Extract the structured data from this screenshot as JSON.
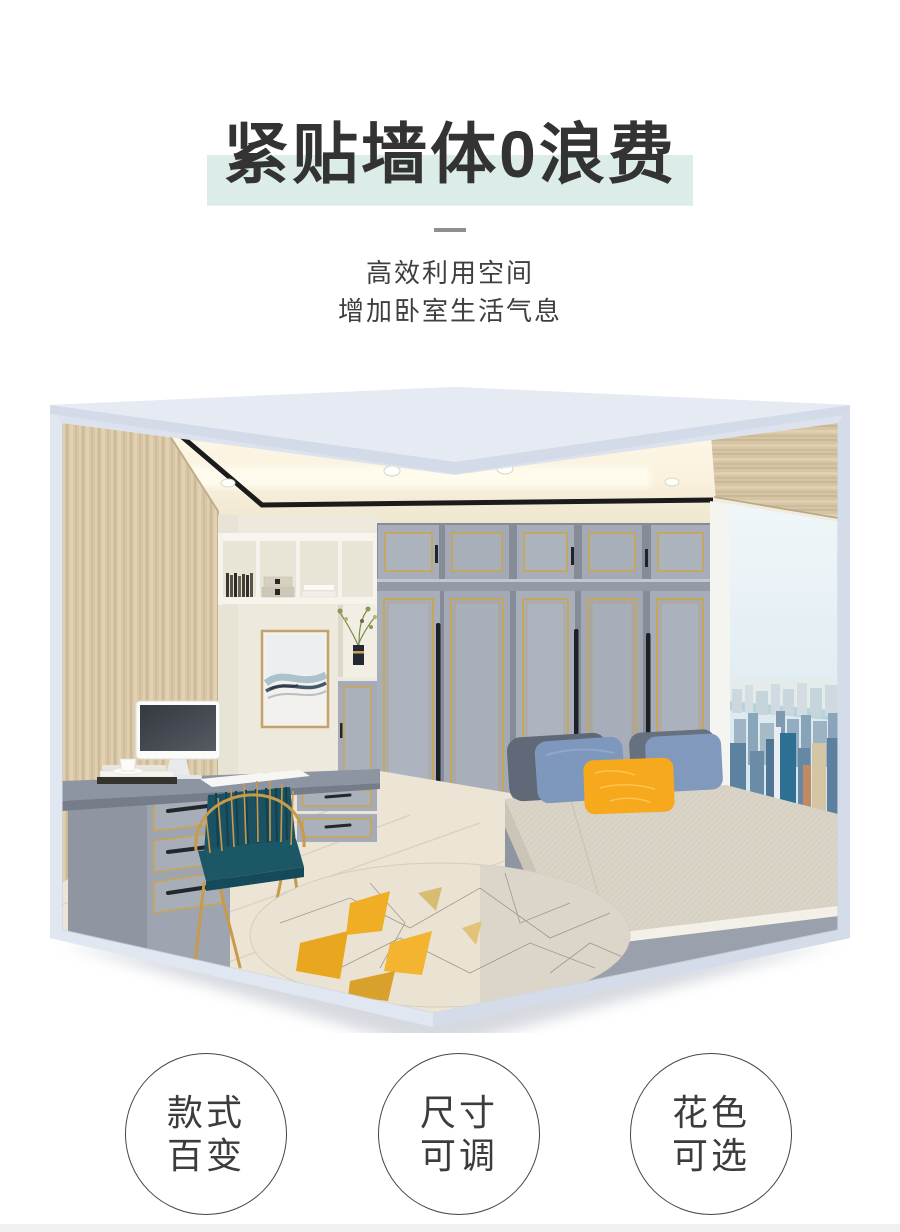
{
  "header": {
    "title": "紧贴墙体0浪费",
    "title_color": "#333333",
    "highlight_color": "#dcede9",
    "subtitle_lines": [
      "高效利用空间",
      "增加卧室生活气息"
    ],
    "subtitle_color": "#3f3f3f"
  },
  "features": [
    {
      "lines": [
        "款式",
        "百变"
      ]
    },
    {
      "lines": [
        "尺寸",
        "可调"
      ]
    },
    {
      "lines": [
        "花色",
        "可选"
      ]
    }
  ],
  "hero": {
    "type": "bedroom-interior-render",
    "palette": {
      "box_frame": "#dde3ee",
      "roof_face": "#e6eaf2",
      "wood_wall": "#d9c7a8",
      "ceiling_glow": "#fdf8ea",
      "wardrobe_gray": "#a8aeb9",
      "gold_trim": "#caa54f",
      "handle_dark": "#1d2126",
      "bed_mattress": "#d9d4c7",
      "pillow_blue": "#7e97bc",
      "pillow_dark": "#5f6978",
      "pillow_orange": "#f6a91c",
      "floor": "#ece5d5",
      "sky": "#e2eef3",
      "city_blue": "#5d82a0",
      "rug_cream": "#eae3d3",
      "rug_yellow": "#f0ae24",
      "chair_gold": "#c89a4c",
      "chair_teal": "#1c5766"
    }
  },
  "footer": {
    "strip_color": "#f0f0f1"
  }
}
